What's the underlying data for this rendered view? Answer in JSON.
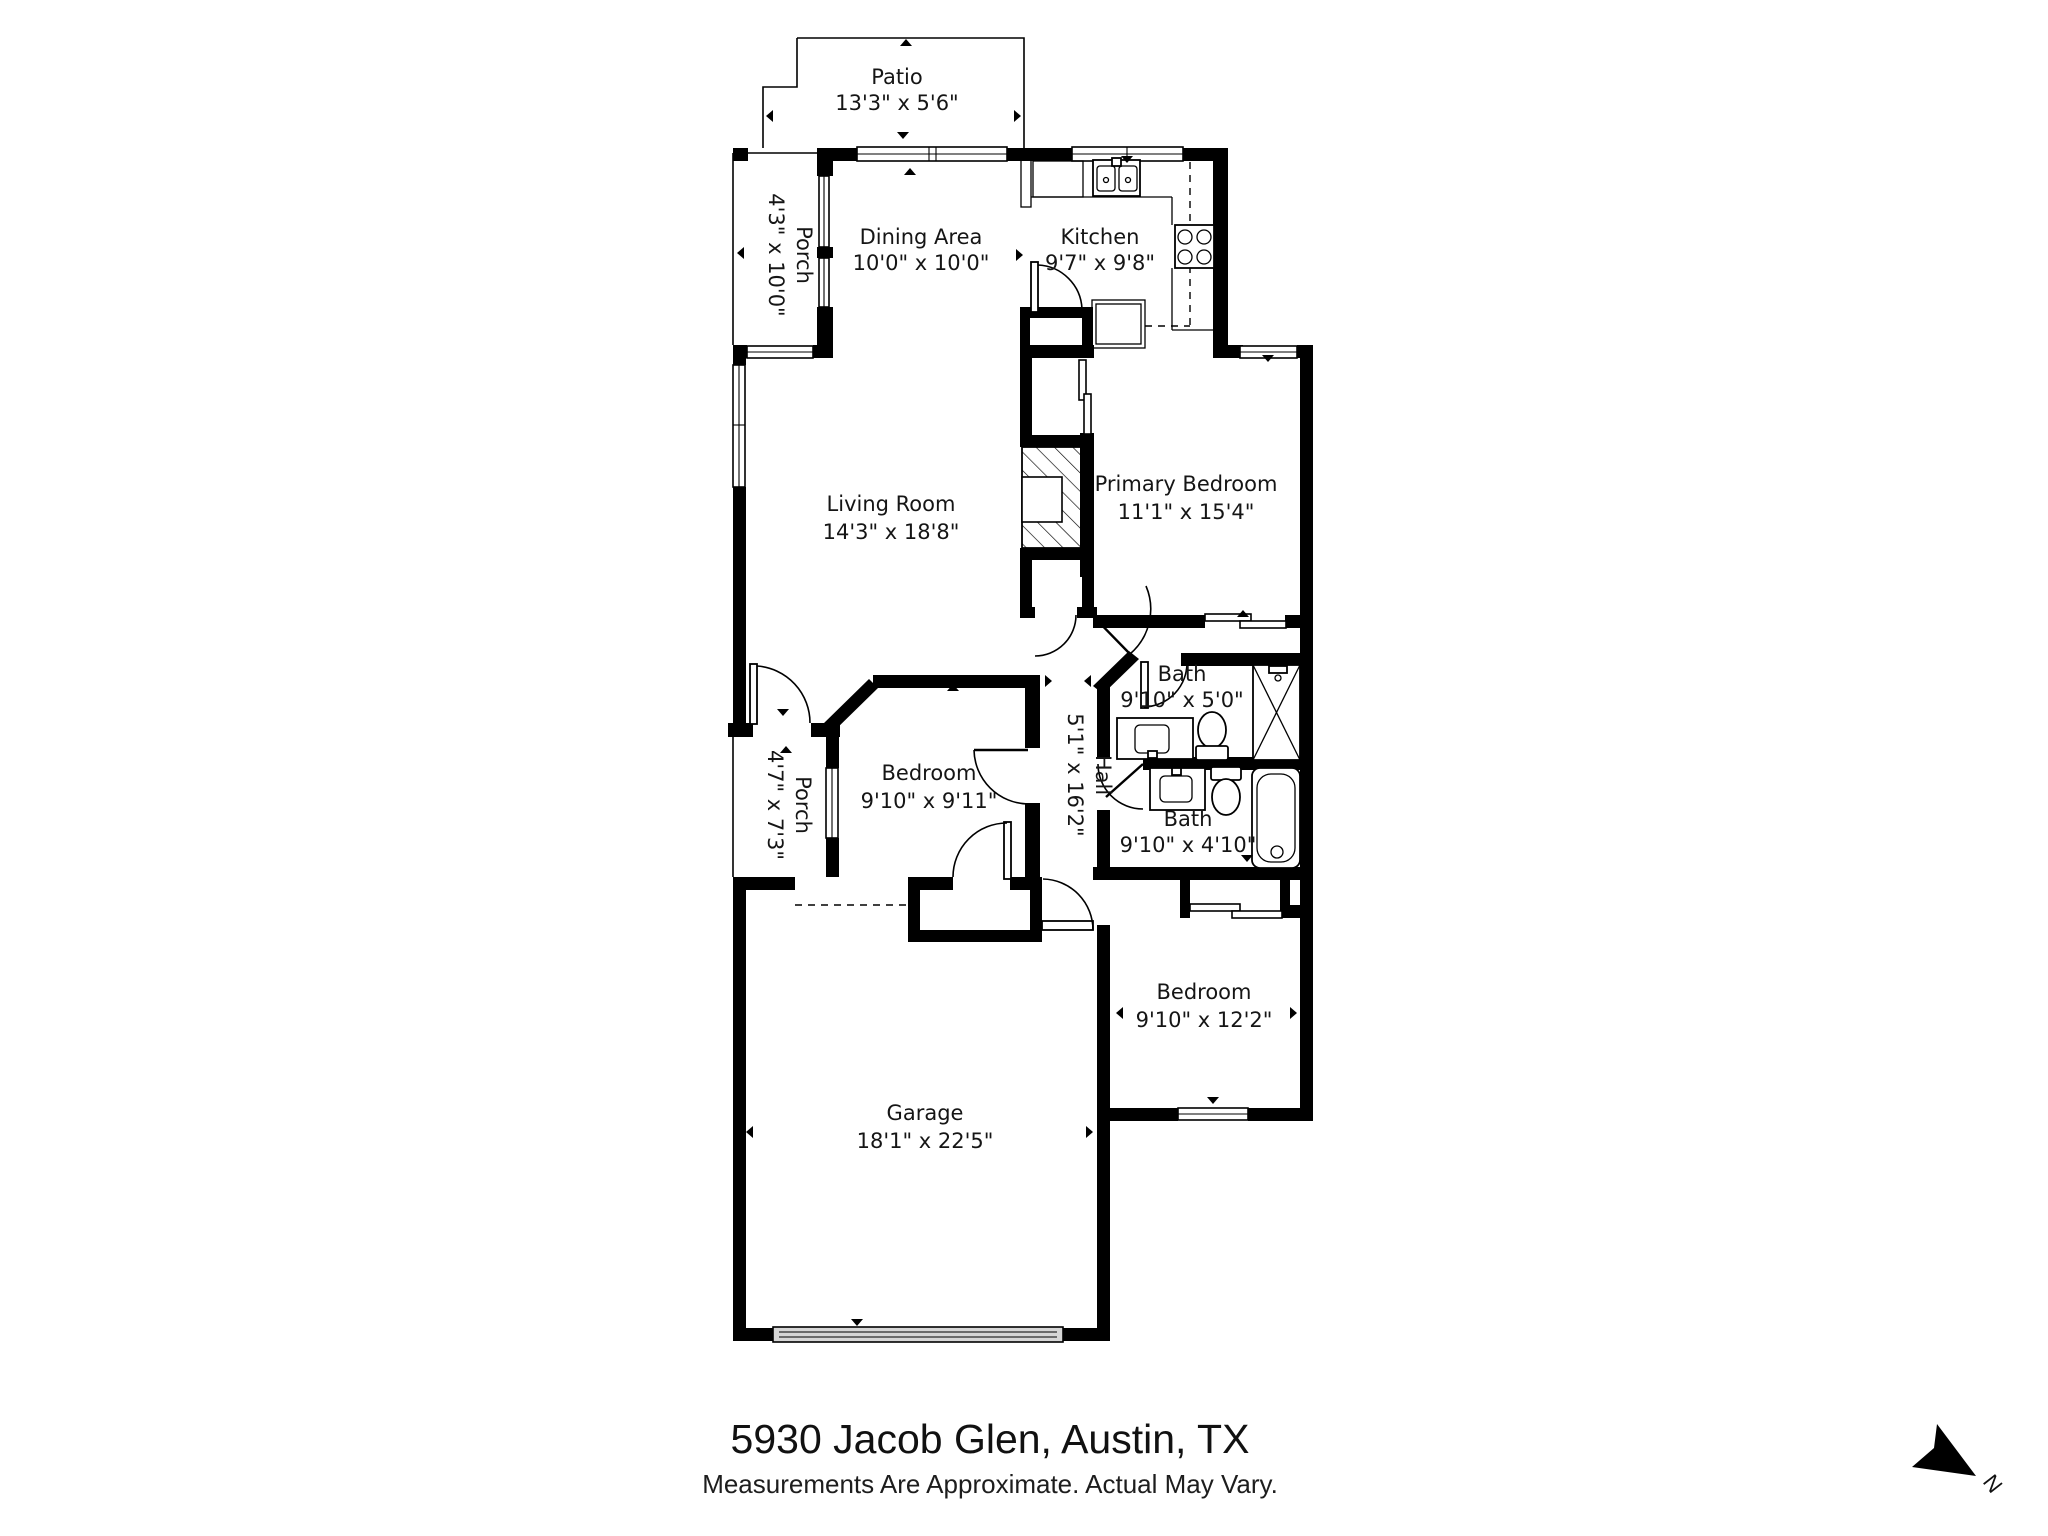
{
  "footer": {
    "address": "5930 Jacob Glen, Austin, TX",
    "disclaimer": "Measurements Are Approximate. Actual May Vary."
  },
  "compass": {
    "label": "N"
  },
  "rooms": [
    {
      "id": "patio",
      "name": "Patio",
      "dims": "13'3\" x 5'6\""
    },
    {
      "id": "porch-upper",
      "name": "Porch",
      "dims": "4'3\" x 10'0\""
    },
    {
      "id": "dining-area",
      "name": "Dining Area",
      "dims": "10'0\" x 10'0\""
    },
    {
      "id": "kitchen",
      "name": "Kitchen",
      "dims": "9'7\" x 9'8\""
    },
    {
      "id": "living-room",
      "name": "Living Room",
      "dims": "14'3\" x 18'8\""
    },
    {
      "id": "primary-bedroom",
      "name": "Primary Bedroom",
      "dims": "11'1\" x 15'4\""
    },
    {
      "id": "bath-upper",
      "name": "Bath",
      "dims": "9'10\" x 5'0\""
    },
    {
      "id": "hall",
      "name": "Hall",
      "dims": "5'1\" x 16'2\""
    },
    {
      "id": "bedroom-middle",
      "name": "Bedroom",
      "dims": "9'10\" x 9'11\""
    },
    {
      "id": "porch-front",
      "name": "Porch",
      "dims": "4'7\" x 7'3\""
    },
    {
      "id": "bath-lower",
      "name": "Bath",
      "dims": "9'10\" x 4'10\""
    },
    {
      "id": "bedroom-rear",
      "name": "Bedroom",
      "dims": "9'10\" x 12'2\""
    },
    {
      "id": "garage",
      "name": "Garage",
      "dims": "18'1\" x 22'5\""
    }
  ]
}
